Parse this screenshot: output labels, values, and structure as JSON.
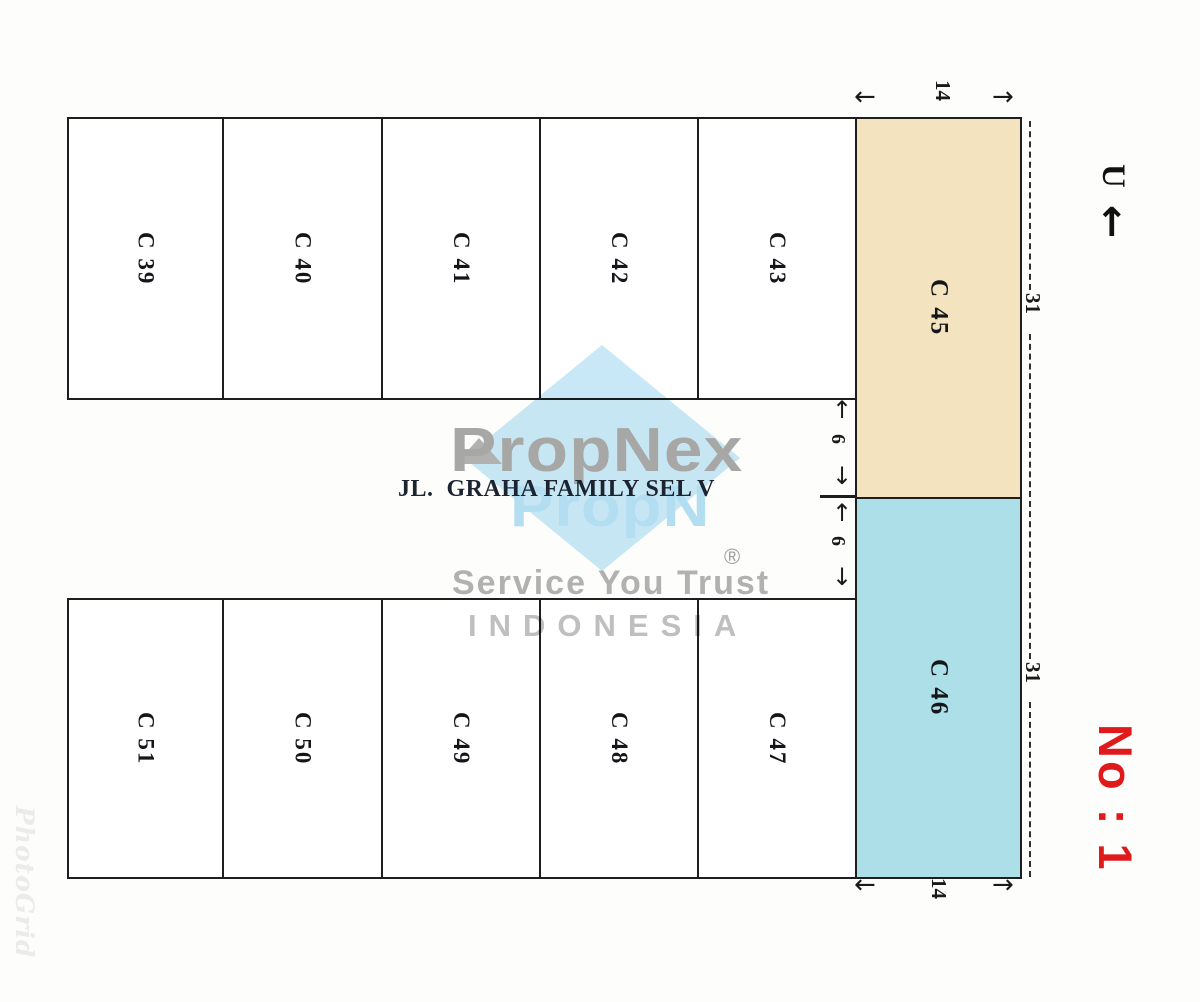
{
  "diagram": {
    "street_label": "JL.  GRAHA FAMILY SEL V",
    "north_label": "U",
    "sheet_number": "No : 1",
    "top_row_lots": [
      {
        "id": "C 39"
      },
      {
        "id": "C 40"
      },
      {
        "id": "C 41"
      },
      {
        "id": "C 42"
      },
      {
        "id": "C 43"
      }
    ],
    "bottom_row_lots": [
      {
        "id": "C 51"
      },
      {
        "id": "C 50"
      },
      {
        "id": "C 49"
      },
      {
        "id": "C 48"
      },
      {
        "id": "C 47"
      }
    ],
    "corner_lots": [
      {
        "id": "C 45",
        "fill": "#f3e3be"
      },
      {
        "id": "C 46",
        "fill": "#addfe9"
      }
    ],
    "dimensions": {
      "top_width": "14",
      "bottom_width": "14",
      "c45_depth": "31",
      "c46_depth": "31",
      "road_half_upper": "6",
      "road_half_lower": "6"
    },
    "colors": {
      "line": "#1e1e1e",
      "red_text": "#e01a1a",
      "watermark_blue": "#c9e8f7",
      "watermark_gray": "#a8a8a8"
    }
  },
  "icons": {
    "arrow_left": "←",
    "arrow_right": "→",
    "arrow_up": "↑",
    "arrow_down": "↓",
    "north_arrow": "↑"
  },
  "watermark": {
    "brand": "PropNex",
    "brand_echo": "PropN",
    "registered": "®",
    "tagline": "Service You Trust",
    "country": "INDONESIA",
    "photo_app": "PhotoGrid"
  }
}
